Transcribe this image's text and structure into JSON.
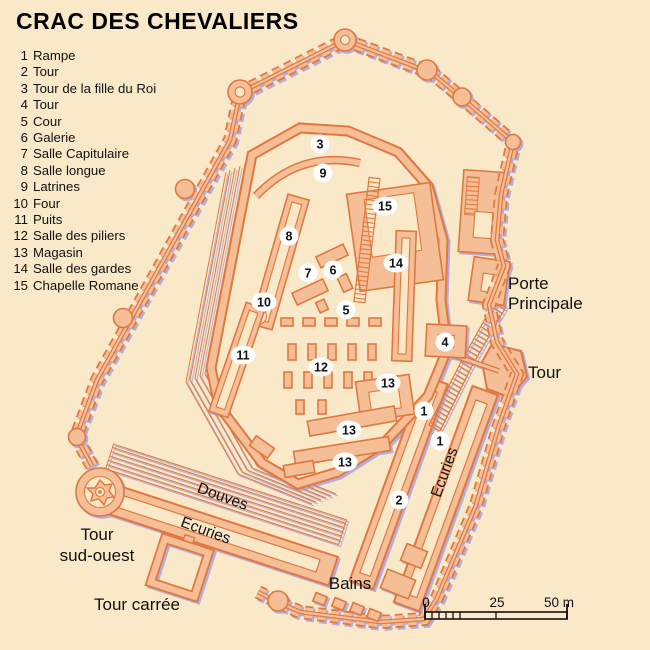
{
  "title": "CRAC DES CHEVALIERS",
  "colors": {
    "background": "#FAE9C8",
    "wall_fill": "#F4BE97",
    "wall_outline": "#E1773F",
    "shadow": "#B3AEDC",
    "text": "#111111",
    "marker_bg": "#FFFFFF"
  },
  "legend": [
    {
      "n": "1",
      "label": "Rampe"
    },
    {
      "n": "2",
      "label": "Tour"
    },
    {
      "n": "3",
      "label": "Tour de la fille du Roi"
    },
    {
      "n": "4",
      "label": "Tour"
    },
    {
      "n": "5",
      "label": "Cour"
    },
    {
      "n": "6",
      "label": "Galerie"
    },
    {
      "n": "7",
      "label": "Salle Capitulaire"
    },
    {
      "n": "8",
      "label": "Salle longue"
    },
    {
      "n": "9",
      "label": "Latrines"
    },
    {
      "n": "10",
      "label": "Four"
    },
    {
      "n": "11",
      "label": "Puits"
    },
    {
      "n": "12",
      "label": "Salle des piliers"
    },
    {
      "n": "13",
      "label": "Magasin"
    },
    {
      "n": "14",
      "label": "Salle des gardes"
    },
    {
      "n": "15",
      "label": "Chapelle Romane"
    }
  ],
  "map": {
    "markers": [
      {
        "n": "3",
        "x": 320,
        "y": 144
      },
      {
        "n": "9",
        "x": 323,
        "y": 173
      },
      {
        "n": "15",
        "x": 385,
        "y": 206
      },
      {
        "n": "8",
        "x": 289,
        "y": 236
      },
      {
        "n": "14",
        "x": 396,
        "y": 263
      },
      {
        "n": "6",
        "x": 333,
        "y": 270
      },
      {
        "n": "7",
        "x": 308,
        "y": 273
      },
      {
        "n": "10",
        "x": 264,
        "y": 302
      },
      {
        "n": "5",
        "x": 346,
        "y": 310
      },
      {
        "n": "4",
        "x": 445,
        "y": 342
      },
      {
        "n": "11",
        "x": 243,
        "y": 355
      },
      {
        "n": "12",
        "x": 321,
        "y": 367
      },
      {
        "n": "13",
        "x": 388,
        "y": 383
      },
      {
        "n": "1",
        "x": 424,
        "y": 411
      },
      {
        "n": "13",
        "x": 349,
        "y": 430
      },
      {
        "n": "1",
        "x": 440,
        "y": 441
      },
      {
        "n": "13",
        "x": 345,
        "y": 462
      },
      {
        "n": "2",
        "x": 399,
        "y": 500
      }
    ],
    "labels": [
      {
        "text": "Porte",
        "x": 508,
        "y": 289,
        "size": 17,
        "anchor": "start",
        "rotate": 0
      },
      {
        "text": "Principale",
        "x": 508,
        "y": 309,
        "size": 17,
        "anchor": "start",
        "rotate": 0
      },
      {
        "text": "Tour",
        "x": 528,
        "y": 378,
        "size": 17,
        "anchor": "start",
        "rotate": 0
      },
      {
        "text": "Ecuries",
        "x": 449,
        "y": 474,
        "size": 15.5,
        "anchor": "middle",
        "rotate": -70
      },
      {
        "text": "Douves",
        "x": 221,
        "y": 501,
        "size": 15.5,
        "anchor": "middle",
        "rotate": 20
      },
      {
        "text": "Ecuries",
        "x": 204,
        "y": 535,
        "size": 15.5,
        "anchor": "middle",
        "rotate": 20
      },
      {
        "text": "Tour",
        "x": 97,
        "y": 540,
        "size": 17,
        "anchor": "middle",
        "rotate": 0
      },
      {
        "text": "sud-ouest",
        "x": 97,
        "y": 561,
        "size": 17,
        "anchor": "middle",
        "rotate": 0
      },
      {
        "text": "Tour carrée",
        "x": 137,
        "y": 610,
        "size": 17,
        "anchor": "middle",
        "rotate": 0
      },
      {
        "text": "Bains",
        "x": 350,
        "y": 589,
        "size": 17,
        "anchor": "middle",
        "rotate": 0
      }
    ],
    "scale_bar": {
      "ticks": [
        {
          "label": "0",
          "x": 426
        },
        {
          "label": "25",
          "x": 497
        },
        {
          "label": "50 m",
          "x": 559
        }
      ]
    }
  }
}
